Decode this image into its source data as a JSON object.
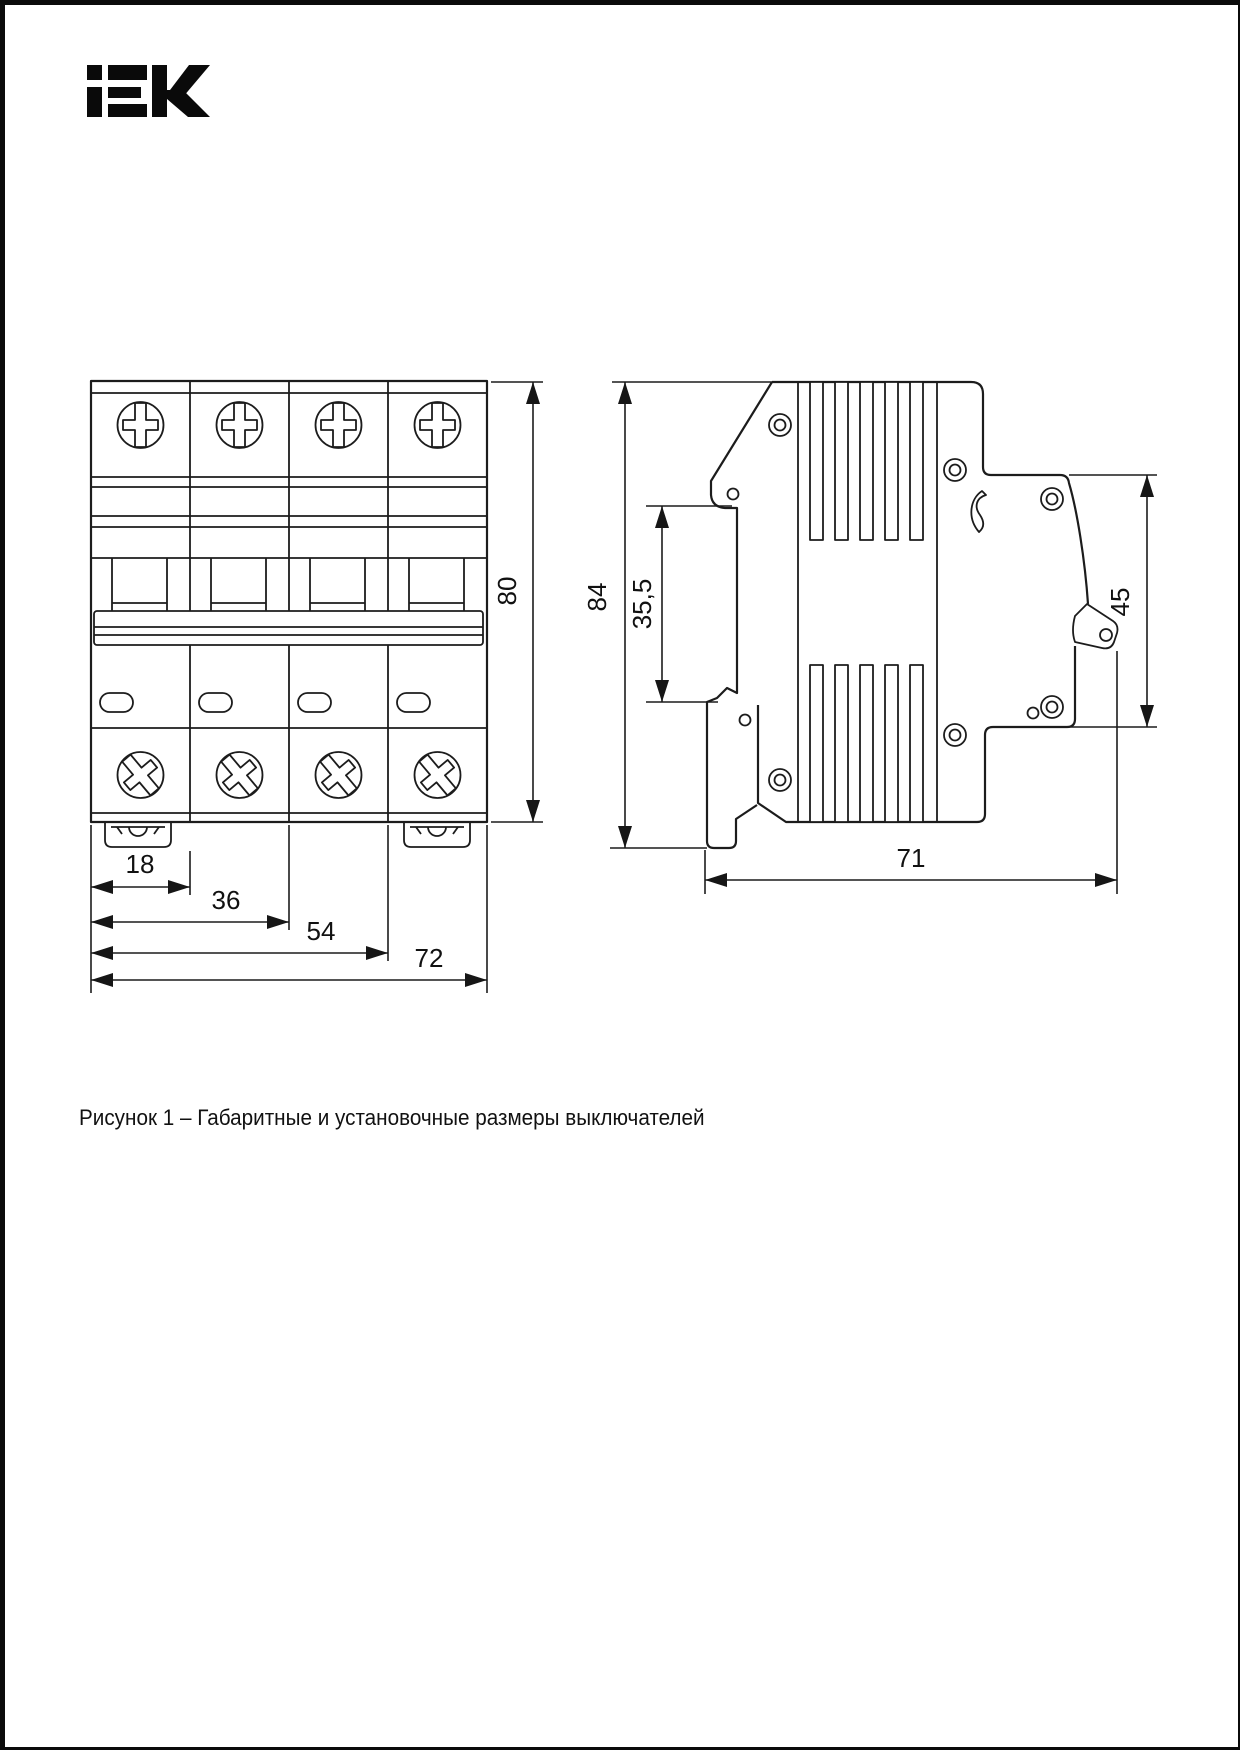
{
  "logo": {
    "text": "iEK"
  },
  "caption": "Рисунок 1 – Габаритные и установочные размеры выключателей",
  "dimensions": {
    "front_view": {
      "module_width": "18",
      "two_modules": "36",
      "three_modules": "54",
      "total_width": "72",
      "height": "80"
    },
    "side_view": {
      "height": "84",
      "rail_recess": "35,5",
      "front_height": "45",
      "depth": "71"
    }
  }
}
